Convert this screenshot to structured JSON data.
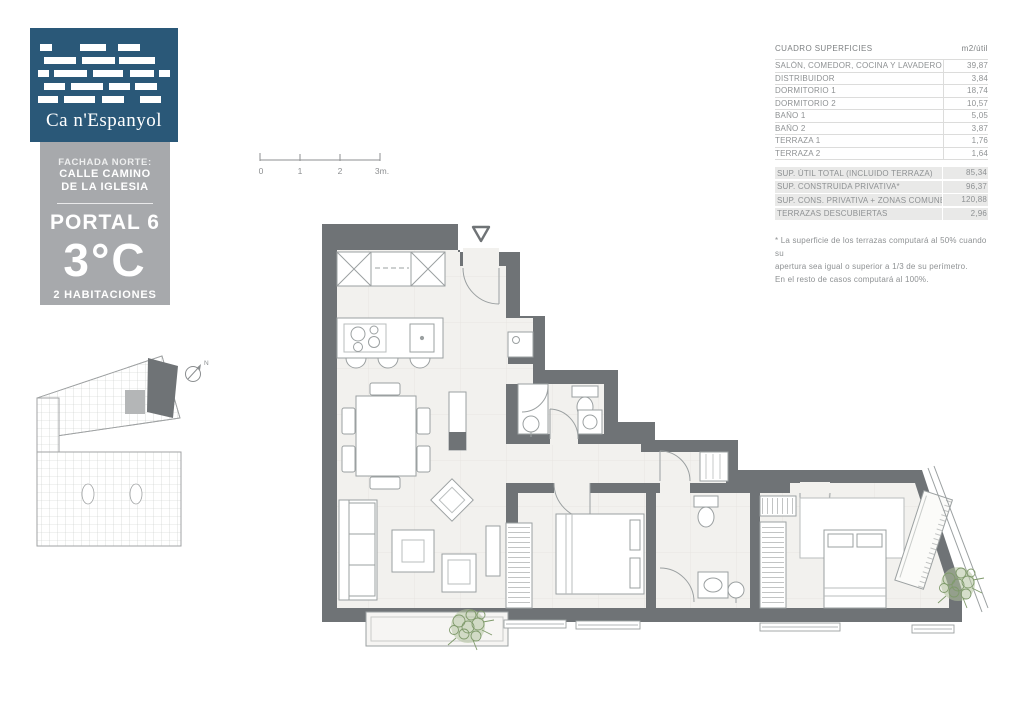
{
  "brand": {
    "name": "Ca n'Espanyol"
  },
  "unit_info": {
    "facade_label": "FACHADA NORTE:",
    "street_line1": "CALLE CAMINO",
    "street_line2": "DE LA IGLESIA",
    "portal": "PORTAL 6",
    "unit": "3°C",
    "rooms": "2 HABITACIONES"
  },
  "scale_bar": {
    "labels": [
      "0",
      "1",
      "2",
      "3m."
    ]
  },
  "compass": {
    "label": "N"
  },
  "surfaces_table": {
    "title": "CUADRO SUPERFICIES",
    "unit_header": "m2/útil",
    "items": [
      {
        "label": "SALÓN, COMEDOR, COCINA Y LAVADERO",
        "value": "39,87"
      },
      {
        "label": "DISTRIBUIDOR",
        "value": "3,84"
      },
      {
        "label": "DORMITORIO 1",
        "value": "18,74"
      },
      {
        "label": "DORMITORIO 2",
        "value": "10,57"
      },
      {
        "label": "BAÑO 1",
        "value": "5,05"
      },
      {
        "label": "BAÑO 2",
        "value": "3,87"
      },
      {
        "label": "TERRAZA 1",
        "value": "1,76"
      },
      {
        "label": "TERRAZA 2",
        "value": "1,64"
      }
    ],
    "totals": [
      {
        "label": "SUP. ÚTIL TOTAL (INCLUIDO TERRAZA)",
        "value": "85,34"
      },
      {
        "label": "SUP. CONSTRUIDA PRIVATIVA*",
        "value": "96,37"
      },
      {
        "label": "SUP. CONS. PRIVATIVA + ZONAS COMUNES",
        "value": "120,88"
      },
      {
        "label": "TERRAZAS DESCUBIERTAS",
        "value": "2,96"
      }
    ],
    "footnote_lines": [
      "* La superficie de los terrazas computará al 50% cuando su",
      "apertura sea igual o superior a 1/3 de su perímetro.",
      "En el resto de casos computará al 100%."
    ]
  },
  "colors": {
    "brand_blue": "#2a5878",
    "panel_gray": "#a7a9ac",
    "wall_gray": "#6f7376",
    "floor": "#f2f1ee",
    "plant_green": "#7f9a6b"
  }
}
